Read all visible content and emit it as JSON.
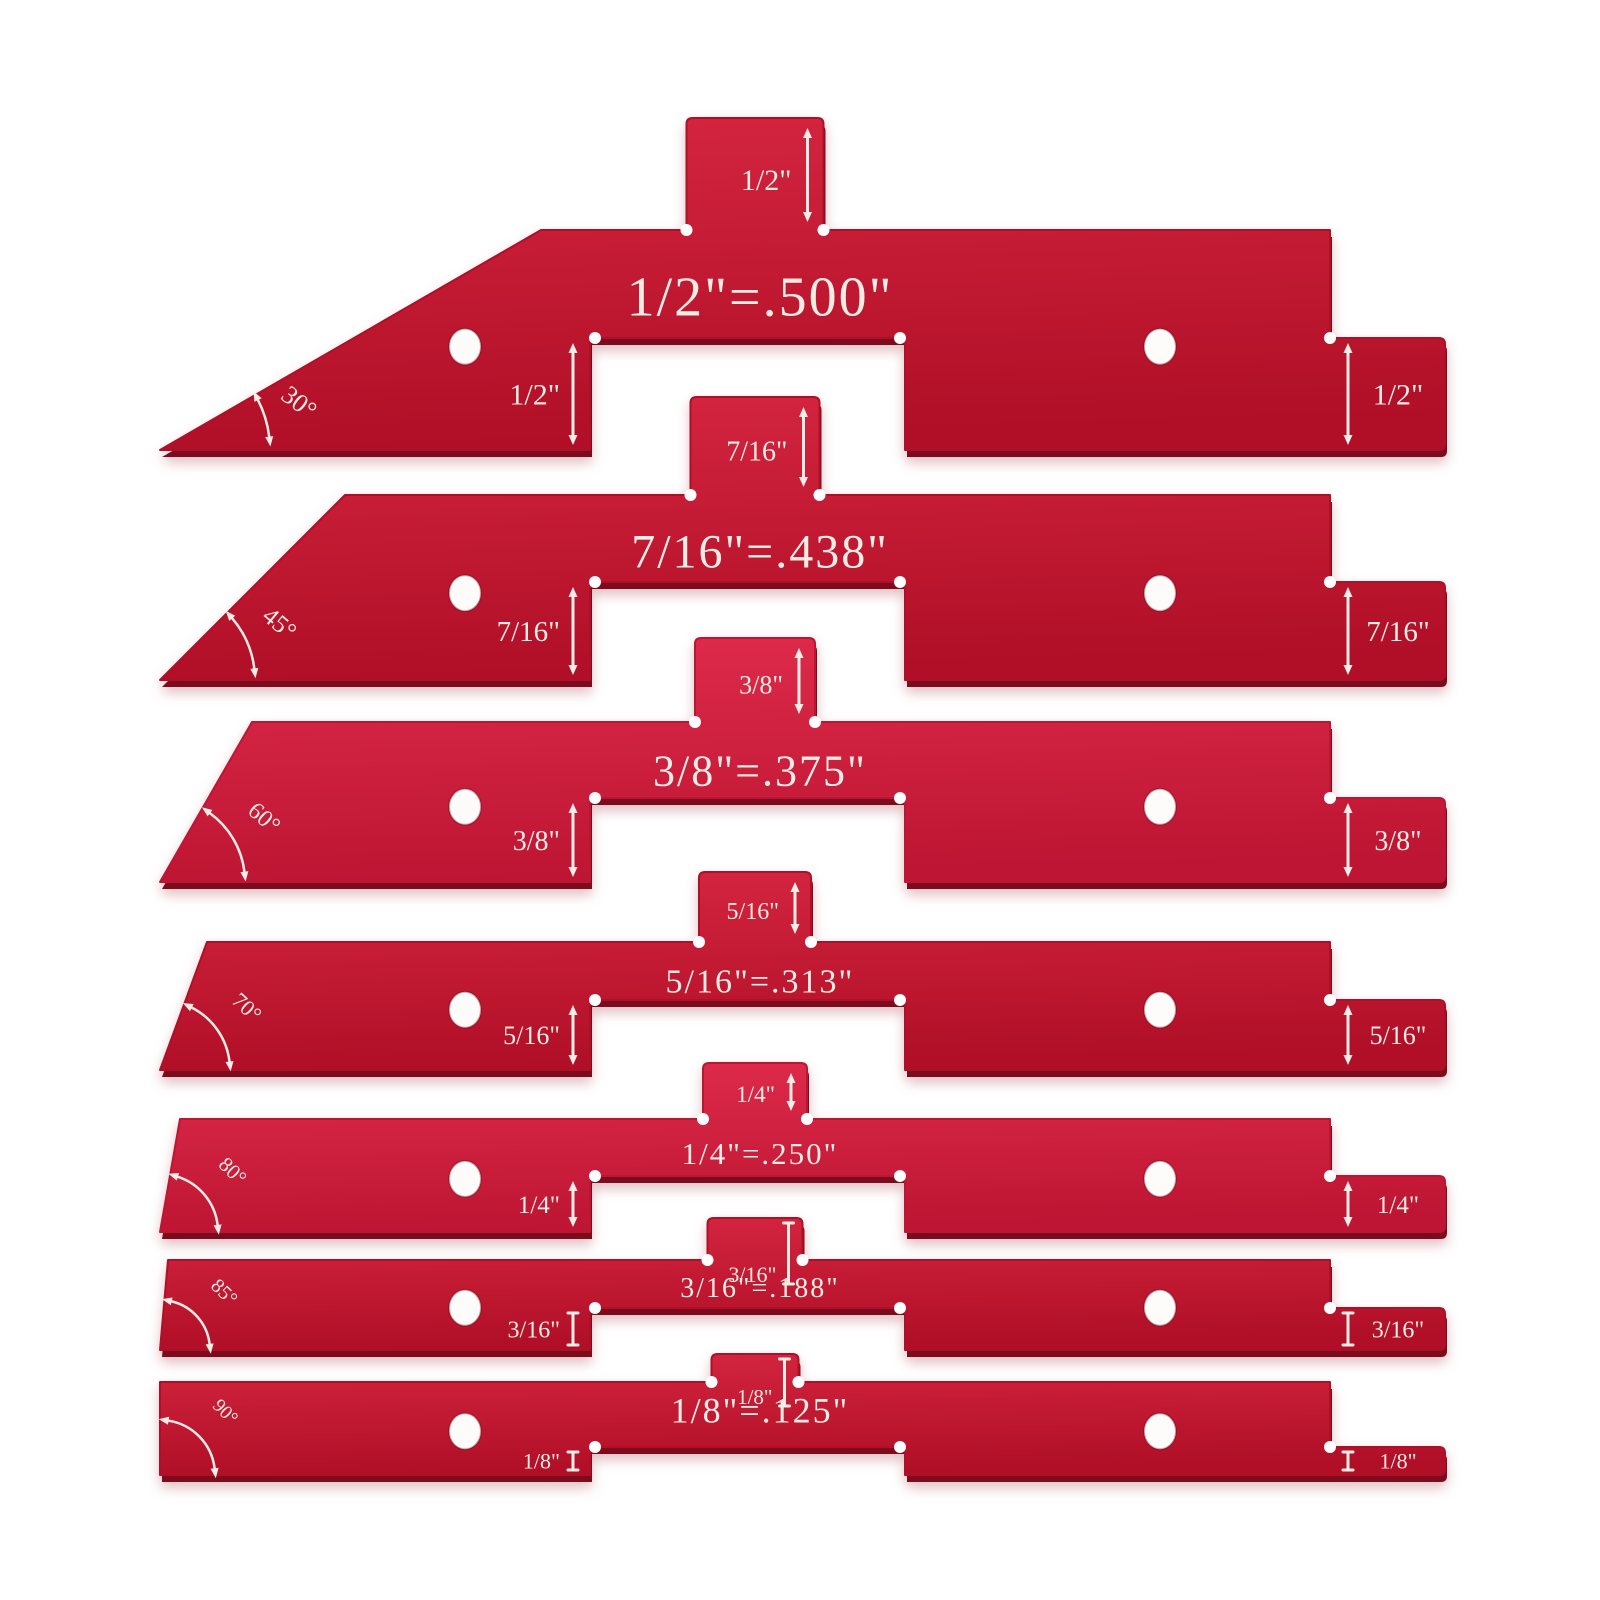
{
  "product": {
    "kind": "setup-height-gauge-bar-set",
    "piece_count": 7
  },
  "colors": {
    "plate_top": "#d52540",
    "plate_bottom": "#b00f27",
    "plate_bright_top": "#df2b4b",
    "plate_bright_bottom": "#bd1533",
    "edge_shadow": "#7c0c1b",
    "engraving": "#f4ece5",
    "background": "#ffffff"
  },
  "bars": [
    {
      "center_text": "1/2\"=.500\"",
      "tab_label": "1/2\"",
      "left_step_label": "1/2\"",
      "right_step_label": "1/2\"",
      "angle_label": "30°"
    },
    {
      "center_text": "7/16\"=.438\"",
      "tab_label": "7/16\"",
      "left_step_label": "7/16\"",
      "right_step_label": "7/16\"",
      "angle_label": "45°"
    },
    {
      "center_text": "3/8\"=.375\"",
      "tab_label": "3/8\"",
      "left_step_label": "3/8\"",
      "right_step_label": "3/8\"",
      "angle_label": "60°"
    },
    {
      "center_text": "5/16\"=.313\"",
      "tab_label": "5/16\"",
      "left_step_label": "5/16\"",
      "right_step_label": "5/16\"",
      "angle_label": "70°"
    },
    {
      "center_text": "1/4\"=.250\"",
      "tab_label": "1/4\"",
      "left_step_label": "1/4\"",
      "right_step_label": "1/4\"",
      "angle_label": "80°"
    },
    {
      "center_text": "3/16\"=.188\"",
      "tab_label": "3/16\"",
      "left_step_label": "3/16\"",
      "right_step_label": "3/16\"",
      "angle_label": "85°"
    },
    {
      "center_text": "1/8\"=.125\"",
      "tab_label": "1/8\"",
      "left_step_label": "1/8\"",
      "right_step_label": "1/8\"",
      "angle_label": "90°"
    }
  ]
}
